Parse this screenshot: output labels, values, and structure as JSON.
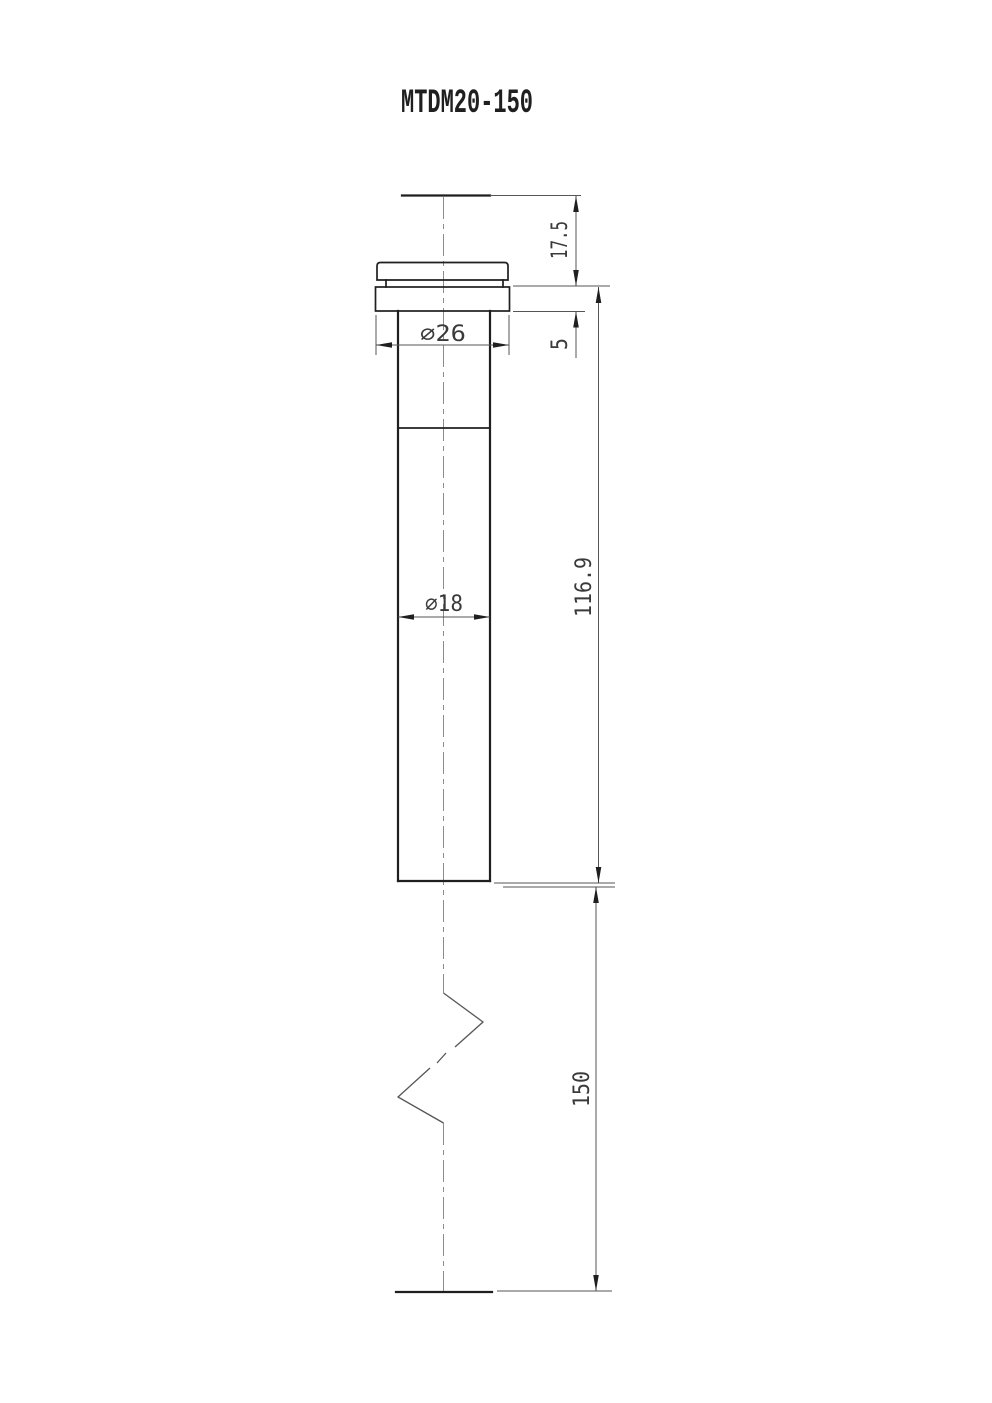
{
  "drawing": {
    "title": "MTDM20-150",
    "dims": {
      "head_height": "17.5",
      "flange_thickness": "5",
      "flange_diameter": "∅26",
      "shaft_diameter": "∅18",
      "upper_length": "116.9",
      "insertion_length": "150"
    },
    "colors": {
      "outline": "#1f1f1f",
      "thin_line": "#565656",
      "center_line": "#8c8c8c",
      "text": "#3a3a3a",
      "background": "#ffffff"
    }
  }
}
